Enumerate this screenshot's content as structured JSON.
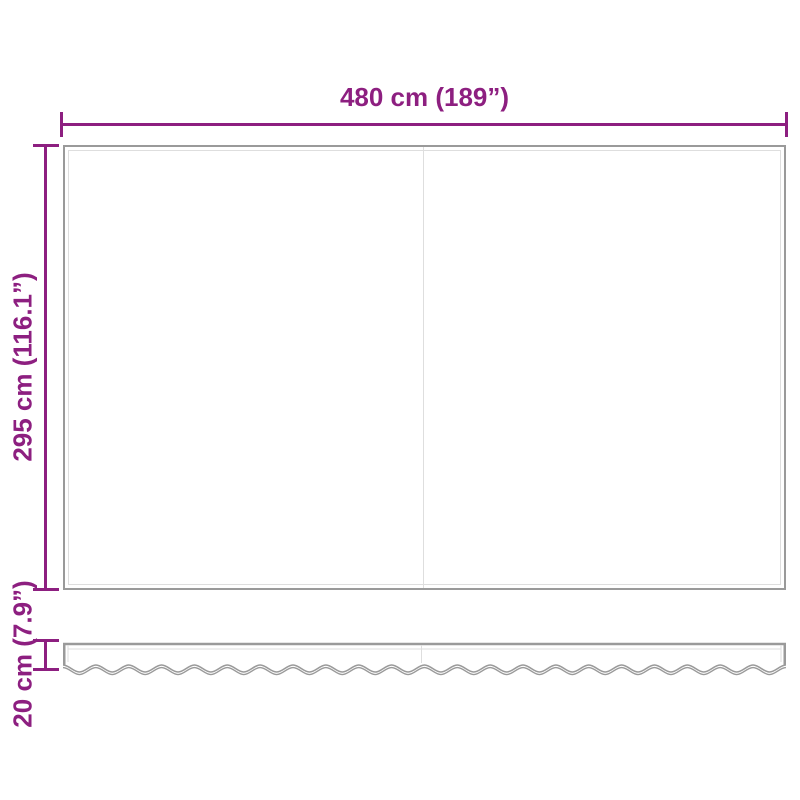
{
  "title": "Awning replacement fabric dimension diagram",
  "labels": {
    "width": "480 cm (189”)",
    "height": "295 cm (116.1”)",
    "valance_height": "20 cm (7.9”)"
  },
  "colors": {
    "dimension": "#8d1f80",
    "fabric_outline": "#9a9a9a",
    "fabric_hairline": "#dedede",
    "background": "#ffffff"
  }
}
